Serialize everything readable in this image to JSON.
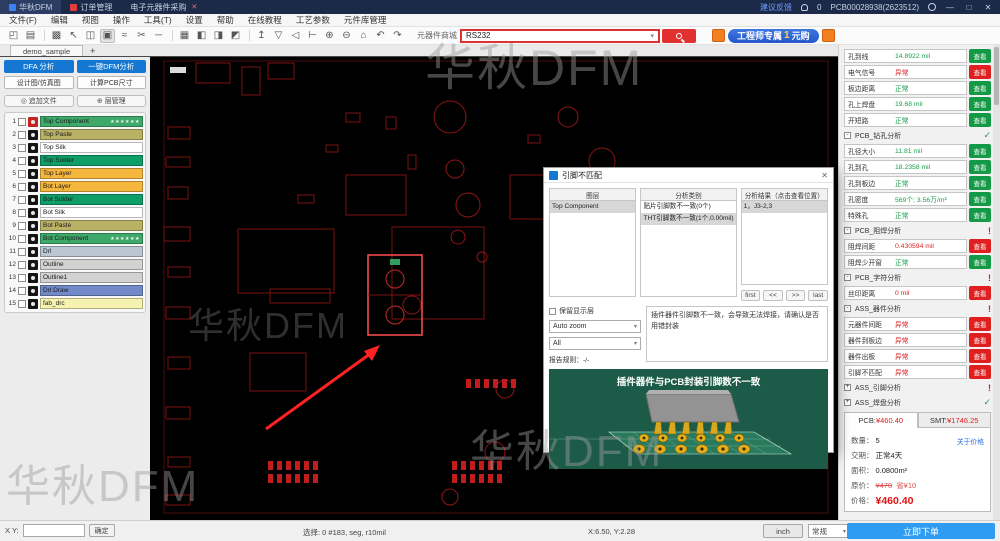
{
  "watermark": "华秋DFM",
  "ui": {
    "caret": "▾"
  },
  "titlebar": {
    "app_tab": "华秋DFM",
    "order_tab": "订单管理",
    "purchase_tab": "电子元器件采购",
    "tab_close": "✕",
    "feedback_link": "建议反馈",
    "bell_count": "0",
    "order_no": "PCB00028938(2623512)",
    "minimize": "—",
    "maximize": "□",
    "close": "✕"
  },
  "menubar": {
    "items": [
      "文件(F)",
      "编辑",
      "视图",
      "操作",
      "工具(T)",
      "设置",
      "帮助",
      "在线教程",
      "工艺参数",
      "元件库管理"
    ]
  },
  "toolbar": {
    "icons": [
      {
        "type": "icon",
        "name": "open-icon",
        "glyph": "◰"
      },
      {
        "type": "icon",
        "name": "print-icon",
        "glyph": "▤"
      },
      {
        "type": "sep",
        "name": "separator",
        "glyph": ""
      },
      {
        "type": "icon",
        "name": "panel-icon",
        "glyph": "▩"
      },
      {
        "type": "icon",
        "name": "select-icon",
        "glyph": "↖"
      },
      {
        "type": "icon",
        "name": "layer-select-icon",
        "glyph": "◫"
      },
      {
        "type": "icon",
        "name": "snapshot-icon",
        "glyph": "▣",
        "pressed": true
      },
      {
        "type": "icon",
        "name": "route-icon",
        "glyph": "≈"
      },
      {
        "type": "icon",
        "name": "cut-icon",
        "glyph": "✂"
      },
      {
        "type": "icon",
        "name": "line-icon",
        "glyph": "─"
      },
      {
        "type": "sep",
        "name": "separator",
        "glyph": ""
      },
      {
        "type": "icon",
        "name": "grid-icon",
        "glyph": "▦"
      },
      {
        "type": "icon",
        "name": "align-left-icon",
        "glyph": "◧"
      },
      {
        "type": "icon",
        "name": "mirror-icon",
        "glyph": "◨"
      },
      {
        "type": "icon",
        "name": "flip-icon",
        "glyph": "◩"
      },
      {
        "type": "sep",
        "name": "separator",
        "glyph": ""
      },
      {
        "type": "icon",
        "name": "pin-icon",
        "glyph": "↥"
      },
      {
        "type": "icon",
        "name": "filter-icon",
        "glyph": "▽"
      },
      {
        "type": "icon",
        "name": "speaker-icon",
        "glyph": "◁"
      },
      {
        "type": "icon",
        "name": "measure-icon",
        "glyph": "⊢"
      },
      {
        "type": "icon",
        "name": "zoom-in-icon",
        "glyph": "⊕"
      },
      {
        "type": "icon",
        "name": "zoom-out-icon",
        "glyph": "⊖"
      },
      {
        "type": "icon",
        "name": "home-icon",
        "glyph": "⌂"
      },
      {
        "type": "icon",
        "name": "undo-icon",
        "glyph": "↶"
      },
      {
        "type": "icon",
        "name": "redo-icon",
        "glyph": "↷"
      }
    ],
    "shop_label": "元器件商城",
    "search_value": "RS232",
    "promo_prefix": "工程师专属",
    "promo_num": "1",
    "promo_suffix": "元购"
  },
  "tabbar": {
    "doc_tab": "demo_sample",
    "add_tab": "+"
  },
  "left_panel": {
    "dfa_button": "DFA 分析",
    "dfm_button": "一键DFM分析",
    "design_button": "设计图/仿真图",
    "size_button": "计算PCB尺寸",
    "add_file_button": "追加文件",
    "layer_mgmt_button": "层管理",
    "add_file_icon": "◎",
    "layer_mgmt_icon": "⊕",
    "layer_stars": "★★★★★★",
    "layers": [
      {
        "no": "1",
        "name": "Top Component",
        "color": "#3fa96b",
        "starred": true,
        "active": true
      },
      {
        "no": "2",
        "name": "Top Paste",
        "color": "#b9b166"
      },
      {
        "no": "3",
        "name": "Top Silk",
        "color": "#ffffff"
      },
      {
        "no": "4",
        "name": "Top Solder",
        "color": "#0f9e68"
      },
      {
        "no": "5",
        "name": "Top Layer",
        "color": "#f5b63e"
      },
      {
        "no": "6",
        "name": "Bot Layer",
        "color": "#f5b63e"
      },
      {
        "no": "7",
        "name": "Bot Solder",
        "color": "#0f9e68"
      },
      {
        "no": "8",
        "name": "Bot Silk",
        "color": "#ffffff"
      },
      {
        "no": "9",
        "name": "Bot Paste",
        "color": "#b9b166"
      },
      {
        "no": "10",
        "name": "Bot Component",
        "color": "#3fa96b",
        "starred": true
      },
      {
        "no": "11",
        "name": "Drl",
        "color": "#bac7d3"
      },
      {
        "no": "12",
        "name": "Outline",
        "color": "#d2d2d2"
      },
      {
        "no": "13",
        "name": "Outline1",
        "color": "#d2d2d2"
      },
      {
        "no": "14",
        "name": "Drl Draw",
        "color": "#7289c8"
      },
      {
        "no": "15",
        "name": "fab_drc",
        "color": "#f6f2af"
      }
    ]
  },
  "dialog": {
    "title": "引脚不匹配",
    "close": "✕",
    "columns": [
      "图层",
      "分析类别",
      "分析结果（点击查看位置）"
    ],
    "layer_items": [
      {
        "text": "Top Component",
        "sel": true
      }
    ],
    "category_items": [
      {
        "text": "贴片引脚数不一致(0个)",
        "sel": false
      },
      {
        "text": "THT引脚数不一致(1个,0.00mil)",
        "sel": true
      }
    ],
    "result_items": [
      {
        "text": "1，J3-2,3",
        "sel": true
      }
    ],
    "nav": [
      {
        "text": "first"
      },
      {
        "text": "<<"
      },
      {
        "text": ">>"
      },
      {
        "text": "last"
      }
    ],
    "keep_layer_label": "保留显示层",
    "zoom_mode": "Auto zoom",
    "filter_mode": "All",
    "report_rule_label": "报告规则：",
    "report_rule_value": "-/-",
    "description": "插件器件引脚数不一致，会导致无法焊接，请确认是否用错封装",
    "preview_title": "插件器件与PCB封装引脚数不一致"
  },
  "right_panel": {
    "view_label": "查看",
    "items": [
      {
        "type": "row",
        "label": "孔到线",
        "value": "14.8922 mil",
        "state": "ok"
      },
      {
        "type": "row",
        "label": "电气信号",
        "value": "异常",
        "state": "bad"
      },
      {
        "type": "row",
        "label": "板边距离",
        "value": "正常",
        "state": "ok"
      },
      {
        "type": "row",
        "label": "孔上焊盘",
        "value": "19.68 mil",
        "state": "ok"
      },
      {
        "type": "row",
        "label": "开短路",
        "value": "正常",
        "state": "ok"
      },
      {
        "type": "section",
        "label": "PCB_钻孔分析",
        "collapse": "-",
        "mark": "✓",
        "state": "ok"
      },
      {
        "type": "row",
        "label": "孔径大小",
        "value": "11.81 mil",
        "state": "ok"
      },
      {
        "type": "row",
        "label": "孔到孔",
        "value": "18.2358 mil",
        "state": "ok"
      },
      {
        "type": "row",
        "label": "孔到板边",
        "value": "正常",
        "state": "ok"
      },
      {
        "type": "row",
        "label": "孔密度",
        "value": "569个; 3.56万/m²",
        "state": "ok"
      },
      {
        "type": "row",
        "label": "特殊孔",
        "value": "正常",
        "state": "ok"
      },
      {
        "type": "section",
        "label": "PCB_阻焊分析",
        "collapse": "-",
        "mark": "!",
        "state": "bad"
      },
      {
        "type": "row",
        "label": "阻焊间距",
        "value": "0.430594 mil",
        "state": "bad"
      },
      {
        "type": "row",
        "label": "阻焊少开窗",
        "value": "正常",
        "state": "ok"
      },
      {
        "type": "section",
        "label": "PCB_字符分析",
        "collapse": "-",
        "mark": "!",
        "state": "bad"
      },
      {
        "type": "row",
        "label": "丝印距离",
        "value": "0 mil",
        "state": "bad"
      },
      {
        "type": "section",
        "label": "ASS_器件分析",
        "collapse": "-",
        "mark": "!",
        "state": "bad"
      },
      {
        "type": "row",
        "label": "元器件间距",
        "value": "异常",
        "state": "bad"
      },
      {
        "type": "row",
        "label": "器件到板边",
        "value": "异常",
        "state": "bad"
      },
      {
        "type": "row",
        "label": "器件出板",
        "value": "异常",
        "state": "bad"
      },
      {
        "type": "row",
        "label": "引脚不匹配",
        "value": "异常",
        "state": "bad"
      },
      {
        "type": "section",
        "label": "ASS_引脚分析",
        "collapse": "+",
        "mark": "!",
        "state": "bad"
      },
      {
        "type": "section",
        "label": "ASS_焊盘分析",
        "collapse": "+",
        "mark": "✓",
        "state": "ok"
      }
    ]
  },
  "price": {
    "pcb_tab_label": "PCB:",
    "pcb_tab_value": "¥460.40",
    "smt_tab_label": "SMT:",
    "smt_tab_value": "¥1746.25",
    "qty_label": "数量：",
    "qty_value": "5",
    "about_link": "关于价格",
    "lead_label": "交期：",
    "lead_value": "正常4天",
    "area_label": "面积：",
    "area_value": "0.0800m²",
    "orig_label": "原价：",
    "orig_value": "¥470",
    "save_value": "省¥10",
    "price_label": "价格：",
    "price_value": "¥460.40",
    "order_button": "立即下单"
  },
  "statusbar": {
    "xy_label": "X Y:",
    "xy_value": "",
    "confirm_button": "确定",
    "selection": "选择: 0 #183, seg, r10mil",
    "coords": "X:6.50, Y:2.28",
    "unit_button": "inch",
    "mode_select": "常规"
  }
}
